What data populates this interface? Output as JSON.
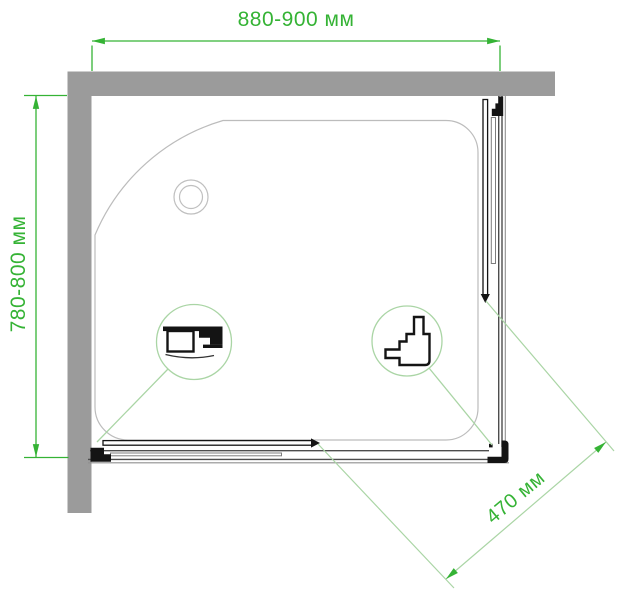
{
  "diagram": {
    "type": "technical-drawing",
    "subject": "Shower enclosure top view plan",
    "dimensions": {
      "width": {
        "label": "880-900 мм",
        "min_mm": 880,
        "max_mm": 900,
        "orientation": "horizontal-top"
      },
      "depth": {
        "label": "780-800 мм",
        "min_mm": 780,
        "max_mm": 800,
        "orientation": "vertical-left"
      },
      "door_opening": {
        "label": "470 мм",
        "value_mm": 470,
        "orientation": "diagonal-bottom-right"
      }
    },
    "colors": {
      "dimension_green": "#35b335",
      "leader_green": "#aad5a5",
      "wall_gray": "#9b9b9b",
      "tray_outline_gray": "#bcbcbc",
      "hardware_black": "#141414",
      "background": "#ffffff"
    },
    "details": {
      "left_callout_icon": "rail-profile-section-icon",
      "right_callout_icon": "corner-roller-profile-section-icon"
    }
  }
}
